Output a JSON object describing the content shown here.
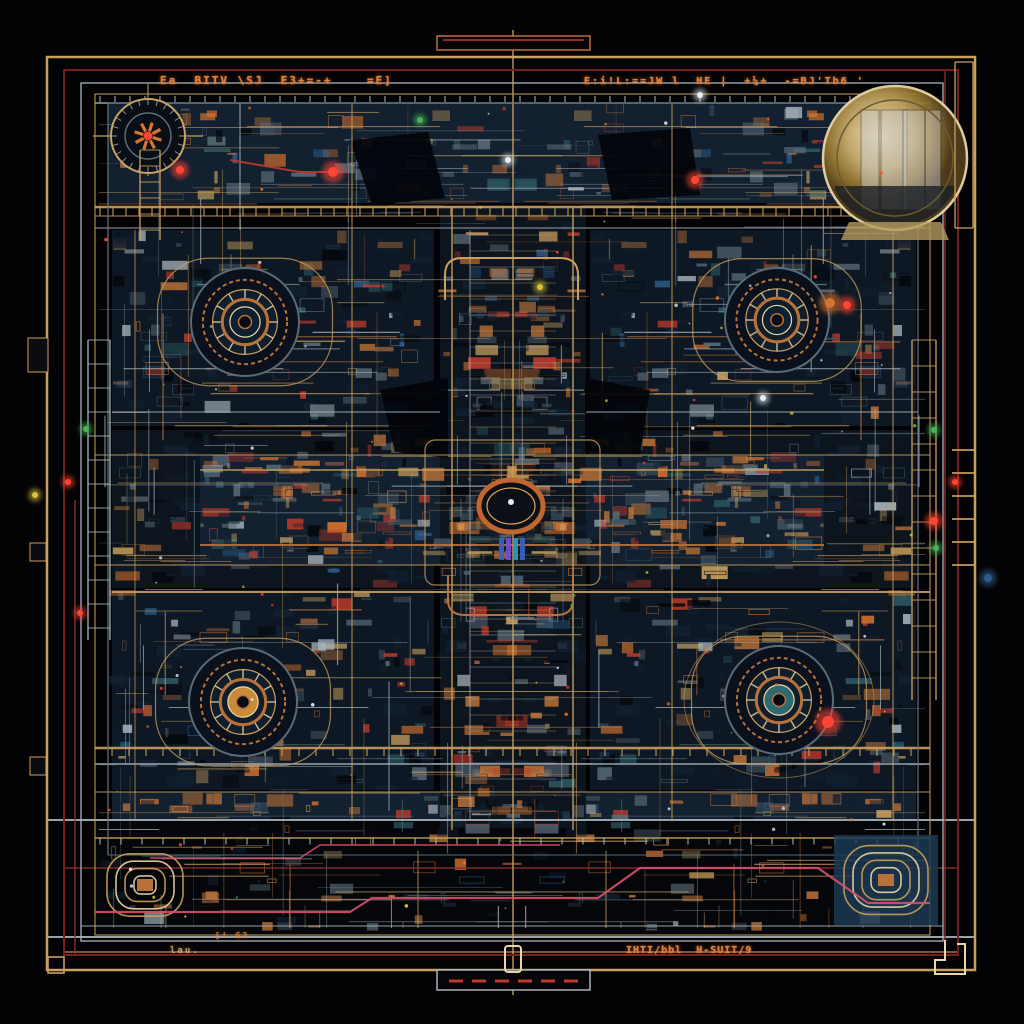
{
  "meta": {
    "background": "#030305"
  },
  "palette": {
    "gold": "#c9a05e",
    "goldBright": "#e9d8a6",
    "copper": "#b9713a",
    "copperDark": "#8a4f26",
    "silver": "#a9b4bb",
    "steel": "#5a6b78",
    "red": "#bf3a2b",
    "redBright": "#ff4433",
    "orange": "#d8732e",
    "pink": "#d94f6b",
    "teal": "#2e5a64",
    "tealBright": "#58b7c4",
    "navy": "#0d1824",
    "panel": "#0c141d",
    "panel2": "#122030",
    "black": "#04060a",
    "green": "#46b554",
    "yellow": "#d8c23a",
    "blue": "#2d5d8a",
    "white": "#e8eef2",
    "darkRed": "#74201c",
    "wine": "#8a2f2f",
    "bluePanel": "#1d3a52"
  },
  "texts": {
    "top_left": {
      "value": "Ea  BITV \\SJ  E3+=-+    =E]"
    },
    "top_right": {
      "value": "E:i!L:==JW l  HE |  +¼+  -=BJ'Tb6 '"
    },
    "bottom_right": {
      "value": "IHTI/bbl  H-SUIT/9"
    },
    "bottom_left_small": {
      "value": "lau."
    },
    "bottom_mid_small": {
      "value": "[! G3"
    }
  },
  "frames": [
    {
      "name": "outer-gold-frame",
      "x": 47,
      "y": 57,
      "w": 928,
      "h": 913,
      "stroke": "gold",
      "sw": 2.5
    },
    {
      "name": "inner-red-frame",
      "x": 64,
      "y": 70,
      "w": 894,
      "h": 885,
      "stroke": "darkRed",
      "sw": 2
    },
    {
      "name": "silver-frame",
      "x": 81,
      "y": 83,
      "w": 862,
      "h": 858,
      "stroke": "silver",
      "sw": 1.3
    },
    {
      "name": "inner-gold-frame",
      "x": 95,
      "y": 94,
      "w": 835,
      "h": 841,
      "stroke": "gold",
      "sw": 1
    },
    {
      "name": "machinery-frame",
      "x": 108,
      "y": 103,
      "w": 810,
      "h": 752,
      "stroke": "steel",
      "sw": 1
    }
  ],
  "panels": [
    {
      "name": "top-band",
      "x": 108,
      "y": 103,
      "w": 810,
      "h": 100,
      "fill": "panel2",
      "tex": 2
    },
    {
      "name": "quad-tl",
      "x": 112,
      "y": 230,
      "w": 322,
      "h": 196,
      "fill": "navy",
      "tex": 2
    },
    {
      "name": "quad-tr",
      "x": 590,
      "y": 230,
      "w": 326,
      "h": 196,
      "fill": "navy",
      "tex": 2
    },
    {
      "name": "mid-left",
      "x": 112,
      "y": 430,
      "w": 322,
      "h": 158,
      "fill": "panel",
      "tex": 2
    },
    {
      "name": "mid-right",
      "x": 590,
      "y": 430,
      "w": 326,
      "h": 158,
      "fill": "panel",
      "tex": 2
    },
    {
      "name": "quad-bl",
      "x": 112,
      "y": 590,
      "w": 322,
      "h": 200,
      "fill": "navy",
      "tex": 2
    },
    {
      "name": "quad-br",
      "x": 590,
      "y": 590,
      "w": 326,
      "h": 200,
      "fill": "navy",
      "tex": 2
    },
    {
      "name": "lower-band",
      "x": 112,
      "y": 792,
      "w": 804,
      "h": 28,
      "fill": "panel2",
      "tex": 3
    },
    {
      "name": "bottom-strip",
      "x": 95,
      "y": 822,
      "w": 835,
      "h": 112,
      "fill": "black",
      "tex": 1
    },
    {
      "name": "center-band",
      "x": 200,
      "y": 455,
      "w": 624,
      "h": 110,
      "fill": "panel2",
      "tex": 3
    },
    {
      "name": "spine-column",
      "x": 440,
      "y": 208,
      "w": 146,
      "h": 620,
      "fill": "panel",
      "tex": 3
    }
  ],
  "blobs": [
    [
      350,
      140,
      428,
      132,
      445,
      198,
      372,
      205
    ],
    [
      598,
      135,
      690,
      128,
      700,
      195,
      612,
      200
    ],
    [
      380,
      390,
      448,
      378,
      448,
      458,
      395,
      452
    ],
    [
      585,
      378,
      650,
      390,
      640,
      455,
      585,
      452
    ]
  ],
  "buses": {
    "horizontal": [
      [
        95,
        930,
        103,
        "silver",
        1.5
      ],
      [
        95,
        930,
        207,
        "gold",
        2.5
      ],
      [
        95,
        930,
        216,
        "gold",
        1
      ],
      [
        95,
        930,
        228,
        "silver",
        1
      ],
      [
        112,
        440,
        412,
        "silver",
        1
      ],
      [
        586,
        918,
        412,
        "silver",
        1
      ],
      [
        95,
        930,
        455,
        "gold",
        1
      ],
      [
        200,
        824,
        470,
        "gold",
        1.5
      ],
      [
        200,
        824,
        545,
        "copper",
        2
      ],
      [
        95,
        930,
        565,
        "gold",
        1
      ],
      [
        112,
        930,
        592,
        "gold",
        2
      ],
      [
        95,
        930,
        748,
        "gold",
        2.5
      ],
      [
        95,
        930,
        764,
        "silver",
        1.5
      ],
      [
        95,
        930,
        792,
        "gold",
        1
      ],
      [
        47,
        975,
        820,
        "silver",
        2
      ],
      [
        95,
        930,
        838,
        "gold",
        1.5
      ],
      [
        63,
        958,
        868,
        "wine",
        1.5
      ],
      [
        47,
        975,
        937,
        "silver",
        2
      ],
      [
        65,
        958,
        952,
        "gold",
        1.2
      ],
      [
        81,
        943,
        926,
        "silver",
        1
      ]
    ],
    "vertical": [
      [
        513,
        30,
        995,
        "gold",
        1.5
      ],
      [
        452,
        208,
        830,
        "gold",
        1.5
      ],
      [
        573,
        208,
        830,
        "gold",
        1.5
      ],
      [
        470,
        230,
        820,
        "silver",
        0.8
      ],
      [
        352,
        103,
        820,
        "gold",
        1
      ],
      [
        672,
        103,
        820,
        "gold",
        1
      ],
      [
        240,
        103,
        230,
        "silver",
        1
      ],
      [
        108,
        103,
        855,
        "silver",
        1.2
      ],
      [
        918,
        103,
        855,
        "silver",
        1.2
      ],
      [
        945,
        70,
        955,
        "wine",
        1.5
      ],
      [
        75,
        500,
        955,
        "wine",
        1.5
      ],
      [
        893,
        230,
        820,
        "gold",
        1
      ],
      [
        135,
        230,
        820,
        "gold",
        0.8
      ]
    ]
  },
  "tick_rows": [
    {
      "y": 211,
      "x1": 100,
      "x2": 918,
      "step": 13,
      "len": 9,
      "color": "gold"
    },
    {
      "y": 752,
      "x1": 112,
      "x2": 918,
      "step": 17,
      "len": 8,
      "color": "gold"
    },
    {
      "y": 841,
      "x1": 100,
      "x2": 918,
      "step": 21,
      "len": 7,
      "color": "silver"
    },
    {
      "y": 99,
      "x1": 100,
      "x2": 918,
      "step": 15,
      "len": 6,
      "color": "silver"
    }
  ],
  "spine_rungs": {
    "x1": 470,
    "x2": 556,
    "y1": 235,
    "y2": 815,
    "step": 16
  },
  "rotors": [
    {
      "cx": 245,
      "cy": 322,
      "r": 54,
      "type": "dark"
    },
    {
      "cx": 777,
      "cy": 320,
      "r": 52,
      "type": "dark"
    },
    {
      "cx": 243,
      "cy": 702,
      "r": 54,
      "type": "gold"
    },
    {
      "cx": 779,
      "cy": 700,
      "r": 54,
      "type": "teal"
    }
  ],
  "dial": {
    "cx": 148,
    "cy": 136,
    "r": 37
  },
  "sphere": {
    "cx": 895,
    "cy": 158,
    "r": 72
  },
  "medallion": {
    "cx": 511,
    "cy": 506,
    "rx": 32,
    "ry": 26
  },
  "coils": [
    {
      "cx": 145,
      "cy": 885,
      "r": 38,
      "panel": false
    },
    {
      "cx": 886,
      "cy": 880,
      "r": 42,
      "panel": true
    }
  ],
  "wires": [
    {
      "pts": [
        95,
        912,
        350,
        912,
        372,
        898,
        598,
        898,
        640,
        868,
        818,
        868,
        868,
        903,
        930,
        903
      ],
      "color": "pink",
      "w": 2.2
    },
    {
      "pts": [
        150,
        858,
        300,
        858,
        320,
        845,
        560,
        845
      ],
      "color": "pink",
      "w": 1.5
    },
    {
      "pts": [
        230,
        160,
        300,
        172,
        333,
        172
      ],
      "color": "red",
      "w": 2
    }
  ],
  "ladders": [
    {
      "x": 88,
      "w": 22,
      "y1": 340,
      "y2": 640,
      "step": 24,
      "color": "silver"
    },
    {
      "x": 140,
      "w": 20,
      "y1": 150,
      "y2": 240,
      "step": 16,
      "color": "gold"
    },
    {
      "x": 912,
      "w": 24,
      "y1": 340,
      "y2": 700,
      "step": 26,
      "color": "gold"
    },
    {
      "x": 955,
      "w": 18,
      "y1": 62,
      "y2": 228,
      "step": 0,
      "color": "gold"
    }
  ],
  "right_ticks": {
    "x": 952,
    "len": 22,
    "y1": 450,
    "y2": 568,
    "step": 23,
    "color": "gold"
  },
  "nodes": [
    {
      "x": 180,
      "y": 170,
      "c": "redBright",
      "r": 4
    },
    {
      "x": 333,
      "y": 172,
      "c": "redBright",
      "r": 5
    },
    {
      "x": 508,
      "y": 160,
      "c": "white",
      "r": 3
    },
    {
      "x": 695,
      "y": 180,
      "c": "redBright",
      "r": 4
    },
    {
      "x": 830,
      "y": 303,
      "c": "orange",
      "r": 5
    },
    {
      "x": 847,
      "y": 305,
      "c": "redBright",
      "r": 4
    },
    {
      "x": 828,
      "y": 722,
      "c": "redBright",
      "r": 6
    },
    {
      "x": 86,
      "y": 429,
      "c": "green",
      "r": 3
    },
    {
      "x": 68,
      "y": 482,
      "c": "redBright",
      "r": 3
    },
    {
      "x": 35,
      "y": 495,
      "c": "yellow",
      "r": 3
    },
    {
      "x": 80,
      "y": 613,
      "c": "redBright",
      "r": 3
    },
    {
      "x": 934,
      "y": 430,
      "c": "green",
      "r": 3
    },
    {
      "x": 955,
      "y": 482,
      "c": "redBright",
      "r": 3
    },
    {
      "x": 934,
      "y": 521,
      "c": "redBright",
      "r": 4
    },
    {
      "x": 936,
      "y": 548,
      "c": "green",
      "r": 3
    },
    {
      "x": 988,
      "y": 578,
      "c": "blue",
      "r": 4
    },
    {
      "x": 763,
      "y": 398,
      "c": "white",
      "r": 3
    },
    {
      "x": 540,
      "y": 287,
      "c": "yellow",
      "r": 3
    },
    {
      "x": 420,
      "y": 120,
      "c": "green",
      "r": 3
    },
    {
      "x": 700,
      "y": 95,
      "c": "white",
      "r": 3
    }
  ],
  "tabs": {
    "top": {
      "x": 437,
      "y": 36,
      "w": 153,
      "h": 14
    },
    "bottom": {
      "x": 437,
      "y": 970,
      "w": 153,
      "h": 20,
      "dashes": 6
    },
    "loop": {
      "x": 505,
      "y": 946,
      "w": 16,
      "h": 26
    },
    "bl_square": {
      "x": 48,
      "y": 957,
      "w": 16,
      "h": 16
    }
  },
  "edge_connectors": [
    {
      "x": 28,
      "y": 338,
      "w": 20,
      "h": 34
    },
    {
      "x": 30,
      "y": 543,
      "w": 16,
      "h": 18
    },
    {
      "x": 30,
      "y": 757,
      "w": 16,
      "h": 18
    }
  ],
  "texture": {
    "seed": 11,
    "lines": 260,
    "sparks": 95
  }
}
